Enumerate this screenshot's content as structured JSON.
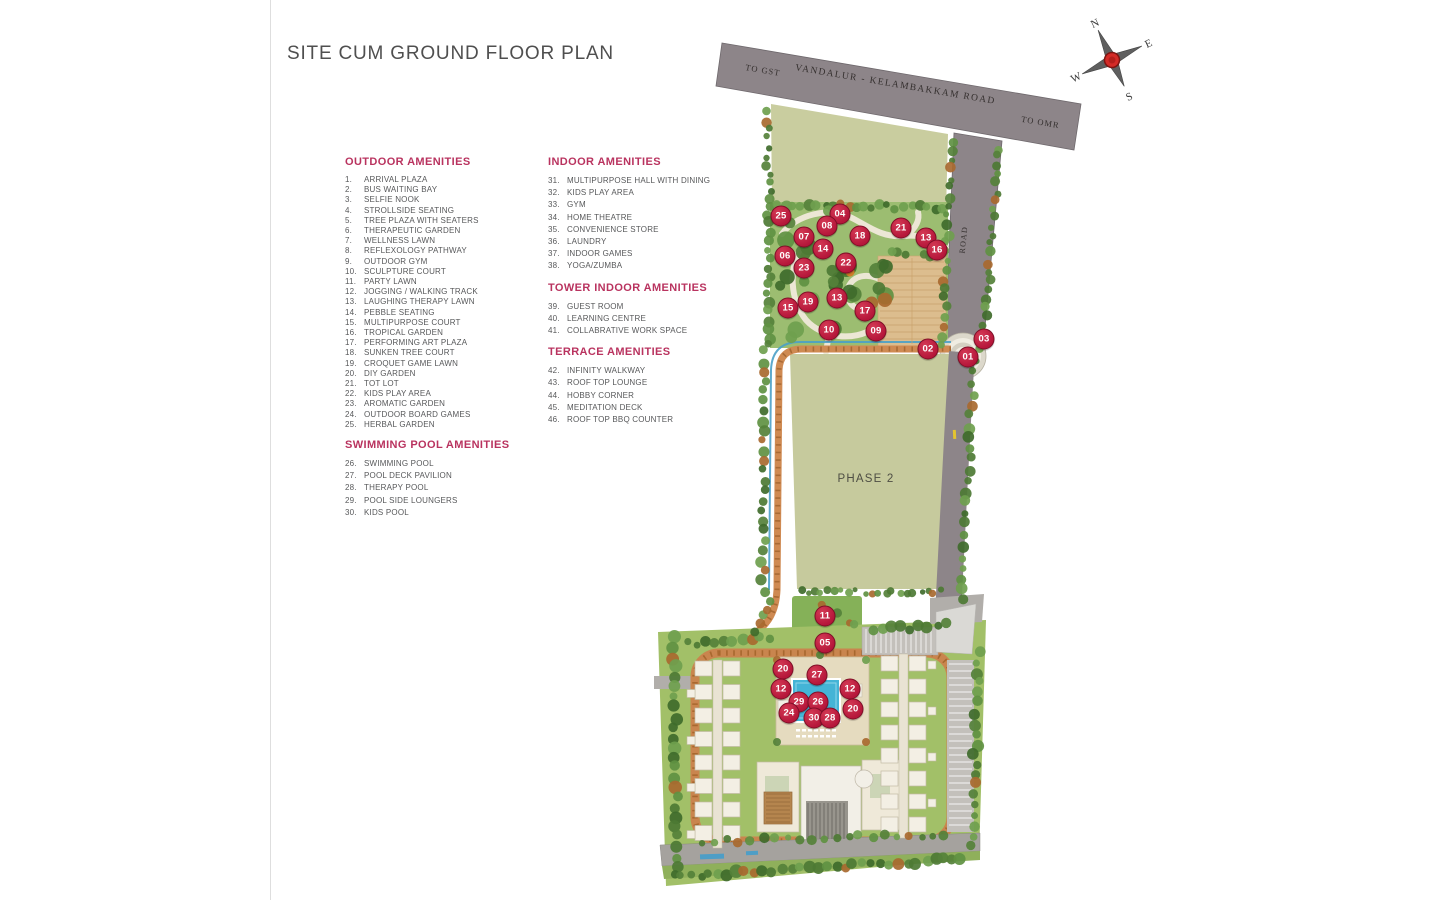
{
  "page": {
    "title": "SITE CUM GROUND FLOOR PLAN"
  },
  "legend": {
    "columns": [
      {
        "sections": [
          {
            "heading": "OUTDOOR AMENITIES",
            "items": [
              {
                "no": "1.",
                "label": "ARRIVAL PLAZA"
              },
              {
                "no": "2.",
                "label": "BUS WAITING BAY"
              },
              {
                "no": "3.",
                "label": "SELFIE NOOK"
              },
              {
                "no": "4.",
                "label": "STROLLSIDE SEATING"
              },
              {
                "no": "5.",
                "label": "TREE PLAZA WITH SEATERS"
              },
              {
                "no": "6.",
                "label": "THERAPEUTIC GARDEN"
              },
              {
                "no": "7.",
                "label": "WELLNESS LAWN"
              },
              {
                "no": "8.",
                "label": "REFLEXOLOGY PATHWAY"
              },
              {
                "no": "9.",
                "label": "OUTDOOR GYM"
              },
              {
                "no": "10.",
                "label": "SCULPTURE COURT"
              },
              {
                "no": "11.",
                "label": "PARTY LAWN"
              },
              {
                "no": "12.",
                "label": "JOGGING / WALKING TRACK"
              },
              {
                "no": "13.",
                "label": "LAUGHING THERAPY LAWN"
              },
              {
                "no": "14.",
                "label": "PEBBLE SEATING"
              },
              {
                "no": "15.",
                "label": "MULTIPURPOSE COURT"
              },
              {
                "no": "16.",
                "label": "TROPICAL GARDEN"
              },
              {
                "no": "17.",
                "label": "PERFORMING ART PLAZA"
              },
              {
                "no": "18.",
                "label": "SUNKEN TREE COURT"
              },
              {
                "no": "19.",
                "label": "CROQUET GAME LAWN"
              },
              {
                "no": "20.",
                "label": "DIY GARDEN"
              },
              {
                "no": "21.",
                "label": "TOT LOT"
              },
              {
                "no": "22.",
                "label": "KIDS PLAY AREA"
              },
              {
                "no": "23.",
                "label": "AROMATIC GARDEN"
              },
              {
                "no": "24.",
                "label": "OUTDOOR BOARD GAMES"
              },
              {
                "no": "25.",
                "label": "HERBAL GARDEN"
              }
            ]
          },
          {
            "heading": "SWIMMING POOL AMENITIES",
            "items": [
              {
                "no": "26.",
                "label": "SWIMMING POOL"
              },
              {
                "no": "27.",
                "label": "POOL DECK PAVILION"
              },
              {
                "no": "28.",
                "label": "THERAPY POOL"
              },
              {
                "no": "29.",
                "label": "POOL SIDE LOUNGERS"
              },
              {
                "no": "30.",
                "label": "KIDS POOL"
              }
            ]
          }
        ]
      },
      {
        "sections": [
          {
            "heading": "INDOOR AMENITIES",
            "items": [
              {
                "no": "31.",
                "label": "MULTIPURPOSE HALL WITH DINING"
              },
              {
                "no": "32.",
                "label": "KIDS PLAY AREA"
              },
              {
                "no": "33.",
                "label": "GYM"
              },
              {
                "no": "34.",
                "label": "HOME THEATRE"
              },
              {
                "no": "35.",
                "label": "CONVENIENCE STORE"
              },
              {
                "no": "36.",
                "label": "LAUNDRY"
              },
              {
                "no": "37.",
                "label": "INDOOR GAMES"
              },
              {
                "no": "38.",
                "label": "YOGA/ZUMBA"
              }
            ]
          },
          {
            "heading": "TOWER INDOOR AMENITIES",
            "items": [
              {
                "no": "39.",
                "label": "GUEST ROOM"
              },
              {
                "no": "40.",
                "label": "LEARNING CENTRE"
              },
              {
                "no": "41.",
                "label": "COLLABRATIVE WORK SPACE"
              }
            ]
          },
          {
            "heading": "TERRACE AMENITIES",
            "items": [
              {
                "no": "42.",
                "label": "INFINITY WALKWAY"
              },
              {
                "no": "43.",
                "label": "ROOF TOP LOUNGE"
              },
              {
                "no": "44.",
                "label": "HOBBY CORNER"
              },
              {
                "no": "45.",
                "label": "MEDITATION DECK"
              },
              {
                "no": "46.",
                "label": "ROOF TOP BBQ COUNTER"
              }
            ]
          }
        ]
      }
    ]
  },
  "map": {
    "roads": {
      "main_label": "VANDALUR - KELAMBAKKAM ROAD",
      "left_label": "TO GST",
      "right_label": "TO OMR",
      "side_label": "ROAD"
    },
    "phase_label": "PHASE 2",
    "compass": {
      "n": "N",
      "e": "E",
      "s": "S",
      "w": "W"
    },
    "markers": [
      {
        "no": "25",
        "x": 781,
        "y": 216
      },
      {
        "no": "04",
        "x": 840,
        "y": 214
      },
      {
        "no": "08",
        "x": 827,
        "y": 226
      },
      {
        "no": "07",
        "x": 804,
        "y": 237
      },
      {
        "no": "18",
        "x": 860,
        "y": 236
      },
      {
        "no": "21",
        "x": 901,
        "y": 228
      },
      {
        "no": "13",
        "x": 926,
        "y": 238
      },
      {
        "no": "16",
        "x": 937,
        "y": 250
      },
      {
        "no": "14",
        "x": 823,
        "y": 249
      },
      {
        "no": "06",
        "x": 785,
        "y": 256
      },
      {
        "no": "22",
        "x": 846,
        "y": 263
      },
      {
        "no": "23",
        "x": 804,
        "y": 268
      },
      {
        "no": "19",
        "x": 808,
        "y": 302
      },
      {
        "no": "13",
        "x": 837,
        "y": 298
      },
      {
        "no": "15",
        "x": 788,
        "y": 308
      },
      {
        "no": "17",
        "x": 865,
        "y": 311
      },
      {
        "no": "10",
        "x": 829,
        "y": 330
      },
      {
        "no": "09",
        "x": 876,
        "y": 331
      },
      {
        "no": "02",
        "x": 928,
        "y": 349
      },
      {
        "no": "01",
        "x": 968,
        "y": 357
      },
      {
        "no": "03",
        "x": 984,
        "y": 339
      },
      {
        "no": "11",
        "x": 825,
        "y": 616
      },
      {
        "no": "05",
        "x": 825,
        "y": 643
      },
      {
        "no": "20",
        "x": 783,
        "y": 669
      },
      {
        "no": "27",
        "x": 817,
        "y": 675
      },
      {
        "no": "12",
        "x": 781,
        "y": 689
      },
      {
        "no": "12",
        "x": 850,
        "y": 689
      },
      {
        "no": "29",
        "x": 799,
        "y": 702
      },
      {
        "no": "26",
        "x": 818,
        "y": 702
      },
      {
        "no": "20",
        "x": 853,
        "y": 709
      },
      {
        "no": "24",
        "x": 789,
        "y": 713
      },
      {
        "no": "30",
        "x": 814,
        "y": 718
      },
      {
        "no": "28",
        "x": 830,
        "y": 718
      }
    ]
  },
  "colors": {
    "heading_accent": "#b9335f",
    "marker_red": "#bf1d40",
    "road_gray": "#8d8589",
    "field_olive": "#c6ca9d",
    "garden_green": "#9cbd71",
    "track_orange": "#cf8a52",
    "pool_blue": "#44b4d6"
  }
}
